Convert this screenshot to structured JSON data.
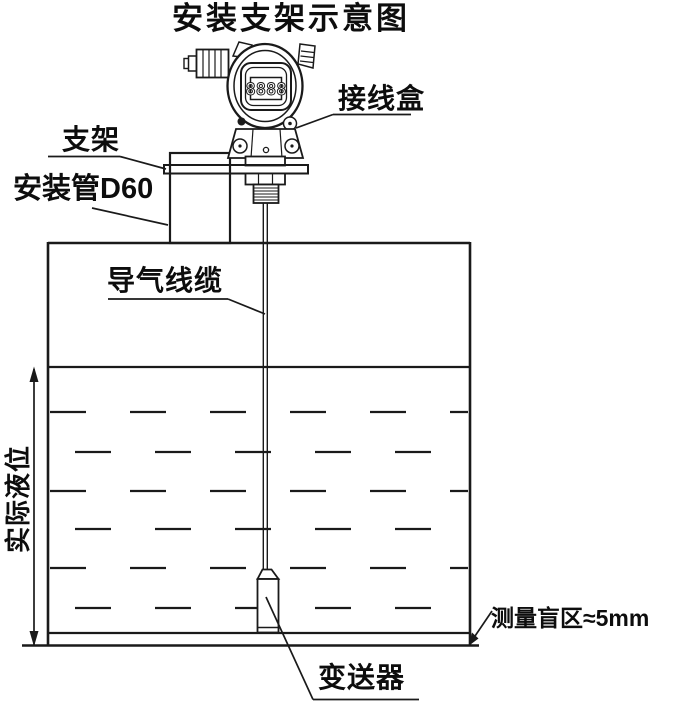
{
  "title": "安装支架示意图",
  "labels": {
    "bracket": "支架",
    "mounting_pipe": "安装管D60",
    "junction_box": "接线盒",
    "air_cable": "导气线缆",
    "actual_level": "实际液位",
    "blind_zone": "测量盲区≈5mm",
    "transmitter": "变送器"
  },
  "device": {
    "lcd_display": "8888"
  },
  "diagram": {
    "liquid_dash_rows_y": [
      412,
      452,
      491,
      529,
      568,
      608
    ],
    "tank": {
      "left": 48,
      "right": 470,
      "top": 243,
      "inner_bottom": 633,
      "outer_bottom": 645
    }
  },
  "colors": {
    "line": "#1a1a1a",
    "background": "#ffffff",
    "text": "#0d0d0d"
  }
}
